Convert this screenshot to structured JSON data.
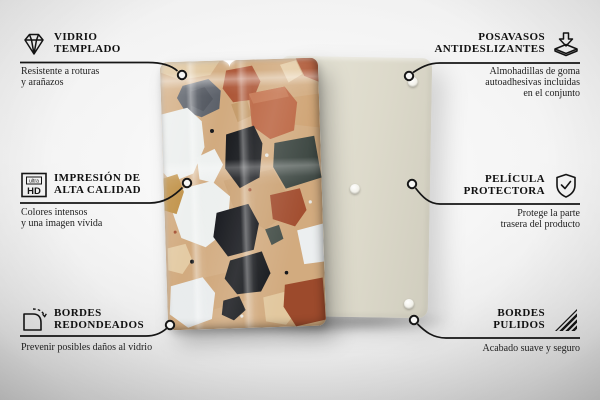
{
  "product": {
    "name": "terrazzo-glass-panel",
    "front_panel": "glass panel with terrazzo print",
    "back_panel": "beige backing board with rubber pads",
    "pads_visible": 3
  },
  "features": {
    "left": [
      {
        "icon": "diamond-icon",
        "title": [
          "VIDRIO",
          "TEMPLADO"
        ],
        "desc": [
          "Resistente a roturas",
          "y arañazos"
        ]
      },
      {
        "icon": "ultra-hd-icon",
        "title": [
          "IMPRESIÓN DE",
          "ALTA CALIDAD"
        ],
        "desc": [
          "Colores intensos",
          "y una imagen vívida"
        ]
      },
      {
        "icon": "rounded-corner-icon",
        "title": [
          "BORDES",
          "REDONDEADOS"
        ],
        "desc": [
          "Prevenir posibles daños al vidrio"
        ]
      }
    ],
    "right": [
      {
        "icon": "non-slip-pads-icon",
        "title": [
          "POSAVASOS",
          "ANTIDESLIZANTES"
        ],
        "desc": [
          "Almohadillas de goma",
          "autoadhesivas incluidas",
          "en el conjunto"
        ]
      },
      {
        "icon": "protective-film-icon",
        "title": [
          "PELÍCULA",
          "PROTECTORA"
        ],
        "desc": [
          "Protege la parte",
          "trasera del producto"
        ]
      },
      {
        "icon": "polished-edges-icon",
        "title": [
          "BORDES",
          "PULIDOS"
        ],
        "desc": [
          "Acabado suave y seguro"
        ]
      }
    ]
  },
  "ultra_hd_icon": {
    "top_text": "ultra",
    "bottom_text": "HD"
  },
  "colors": {
    "line": "#161616",
    "text": "#1b1b1b",
    "background_light": "#f4f4f4",
    "background_dark": "#d2d2d2",
    "back_panel": "#dcd9ca",
    "terrazzo_base": "#d2ab7f",
    "terrazzo_white": "#edf0ef",
    "terrazzo_black": "#15171b",
    "terrazzo_terracotta": "#b35c3a",
    "terrazzo_slate": "#3d4742",
    "terrazzo_mustard": "#bf8f43",
    "terrazzo_gray": "#5a5f68",
    "terrazzo_cream": "#e6cda6"
  }
}
